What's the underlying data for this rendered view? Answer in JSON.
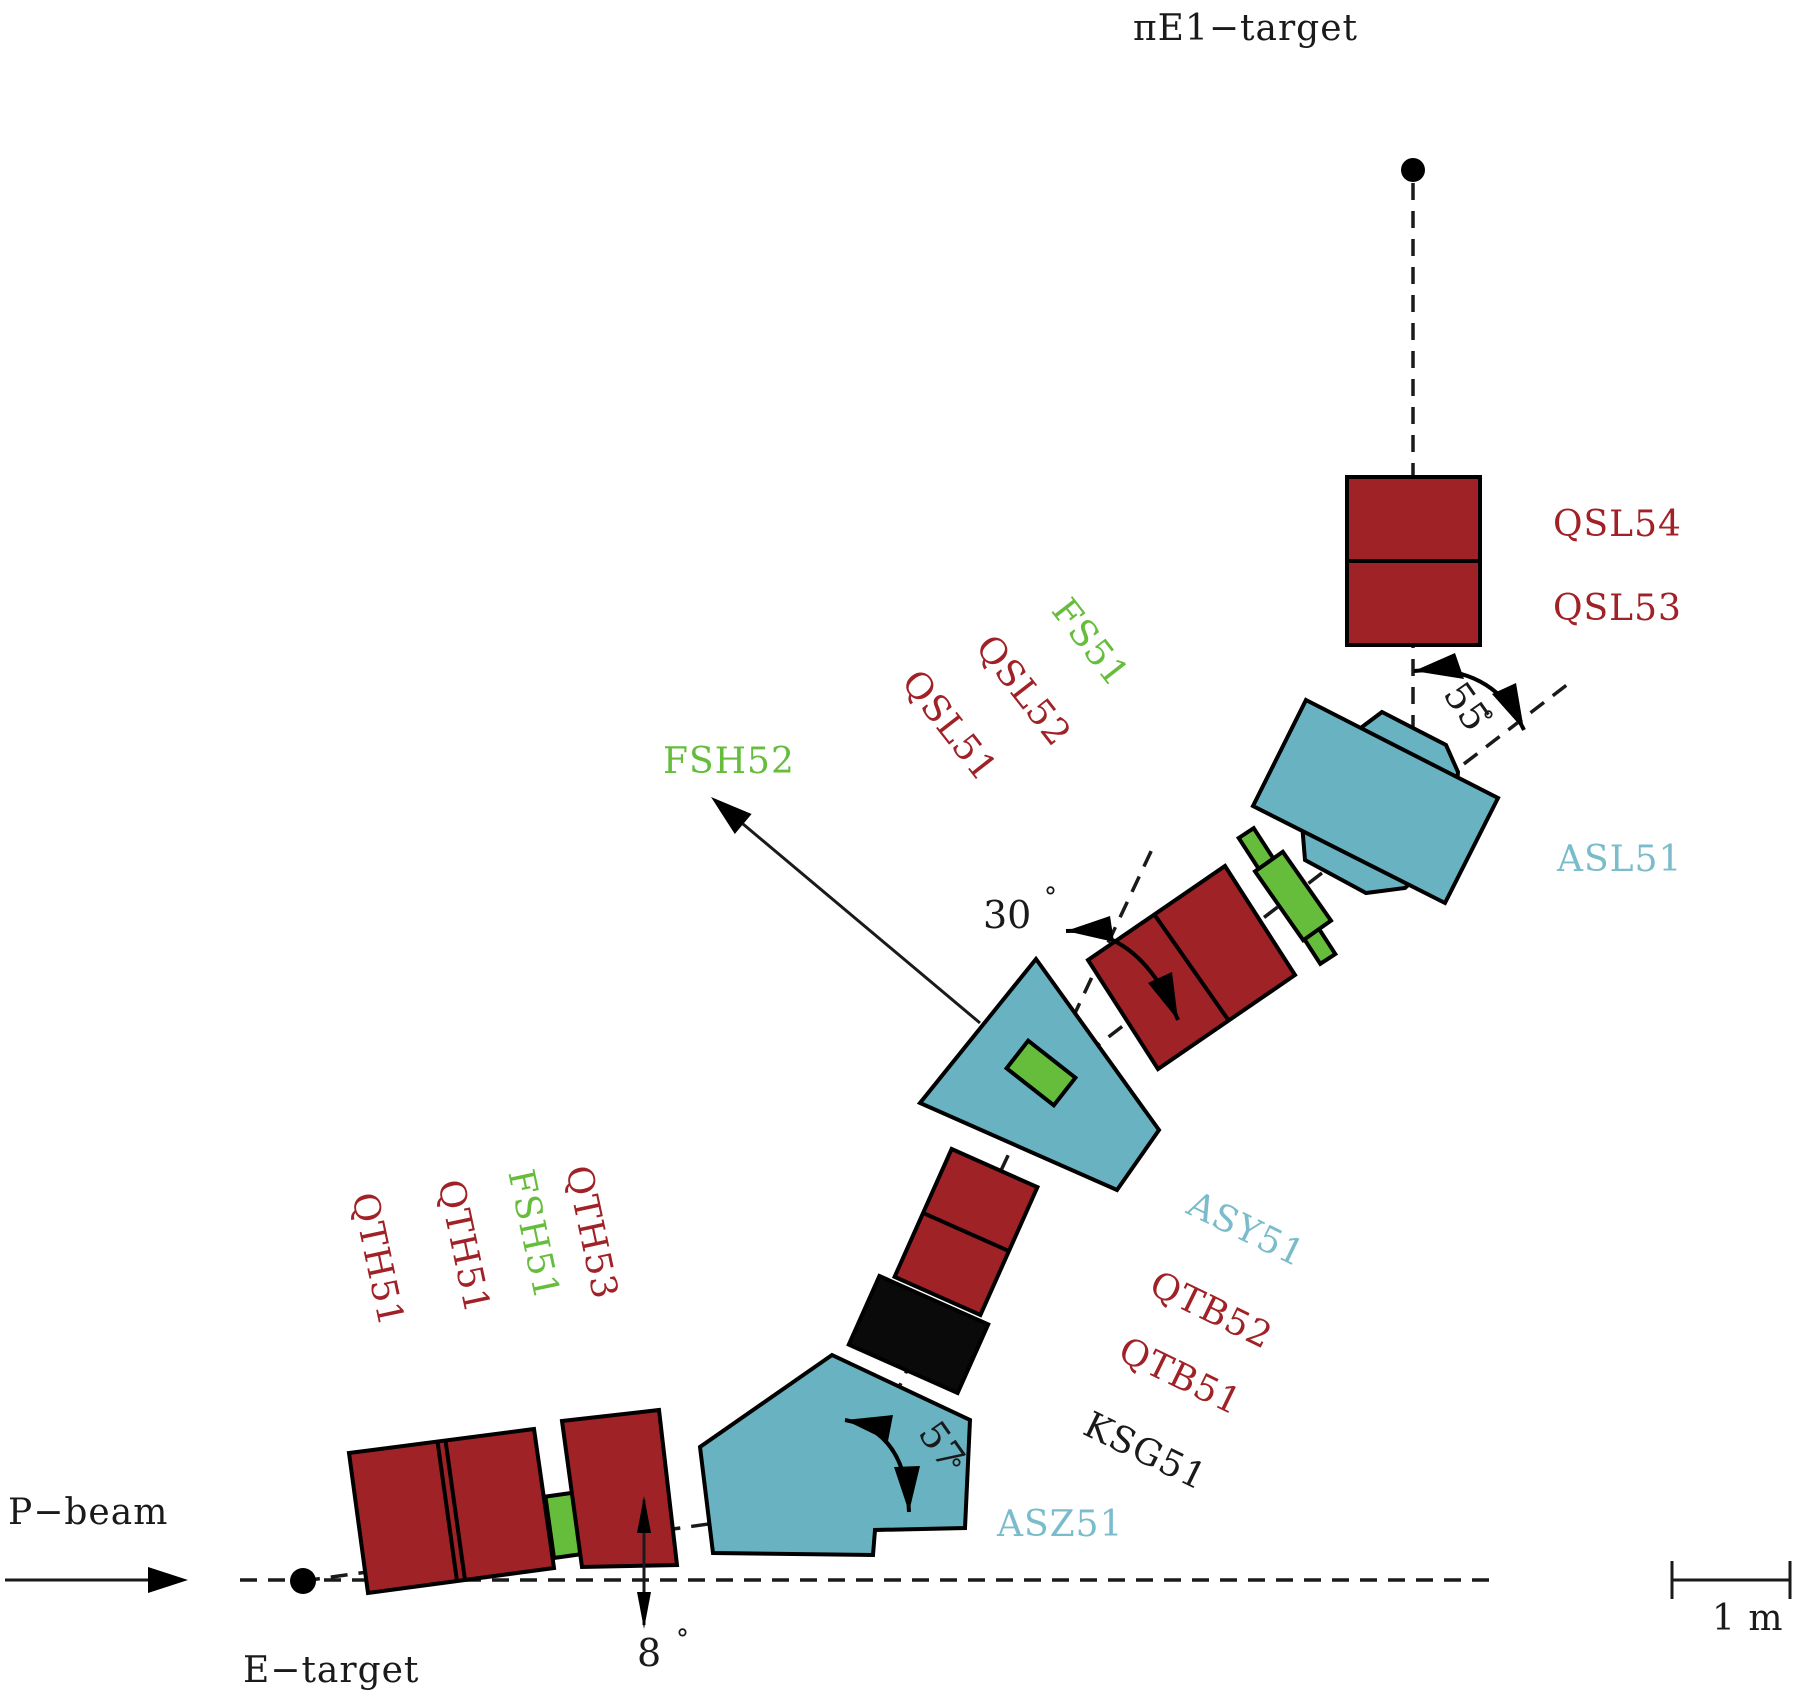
{
  "figure": {
    "title": "πE1 secondary beamline layout",
    "type": "accelerator-beamline-diagram"
  },
  "colors": {
    "magnet_red": "#9e2226",
    "bend_magnet_teal": "#69b2c2",
    "slit_green": "#66bd3c",
    "annotation_black": "#1a1a1a",
    "label_teal": "#7abccb",
    "background": "#ffffff"
  },
  "labels": {
    "pi_e1_target": "πE1−target",
    "p_beam": "P−beam",
    "e_target": "E−target",
    "qsl54": "QSL54",
    "qsl53": "QSL53",
    "asl51": "ASL51",
    "fs51": "FS51",
    "qsl52": "QSL52",
    "qsl51": "QSL51",
    "fsh52": "FSH52",
    "asy51": "ASY51",
    "qtb52": "QTB52",
    "qtb51": "QTB51",
    "ksg51": "KSG51",
    "asz51": "ASZ51",
    "qth51a": "QTH51",
    "qth51b": "QTH51",
    "fsh51": "FSH51",
    "qth53": "QTH53"
  },
  "angles": {
    "asl51_bend": "55",
    "asy51_bend": "30",
    "asz51_bend": "57",
    "etarget_takeoff": "8",
    "degree_symbol": "°"
  },
  "scale": {
    "bar_label": "1 m"
  }
}
